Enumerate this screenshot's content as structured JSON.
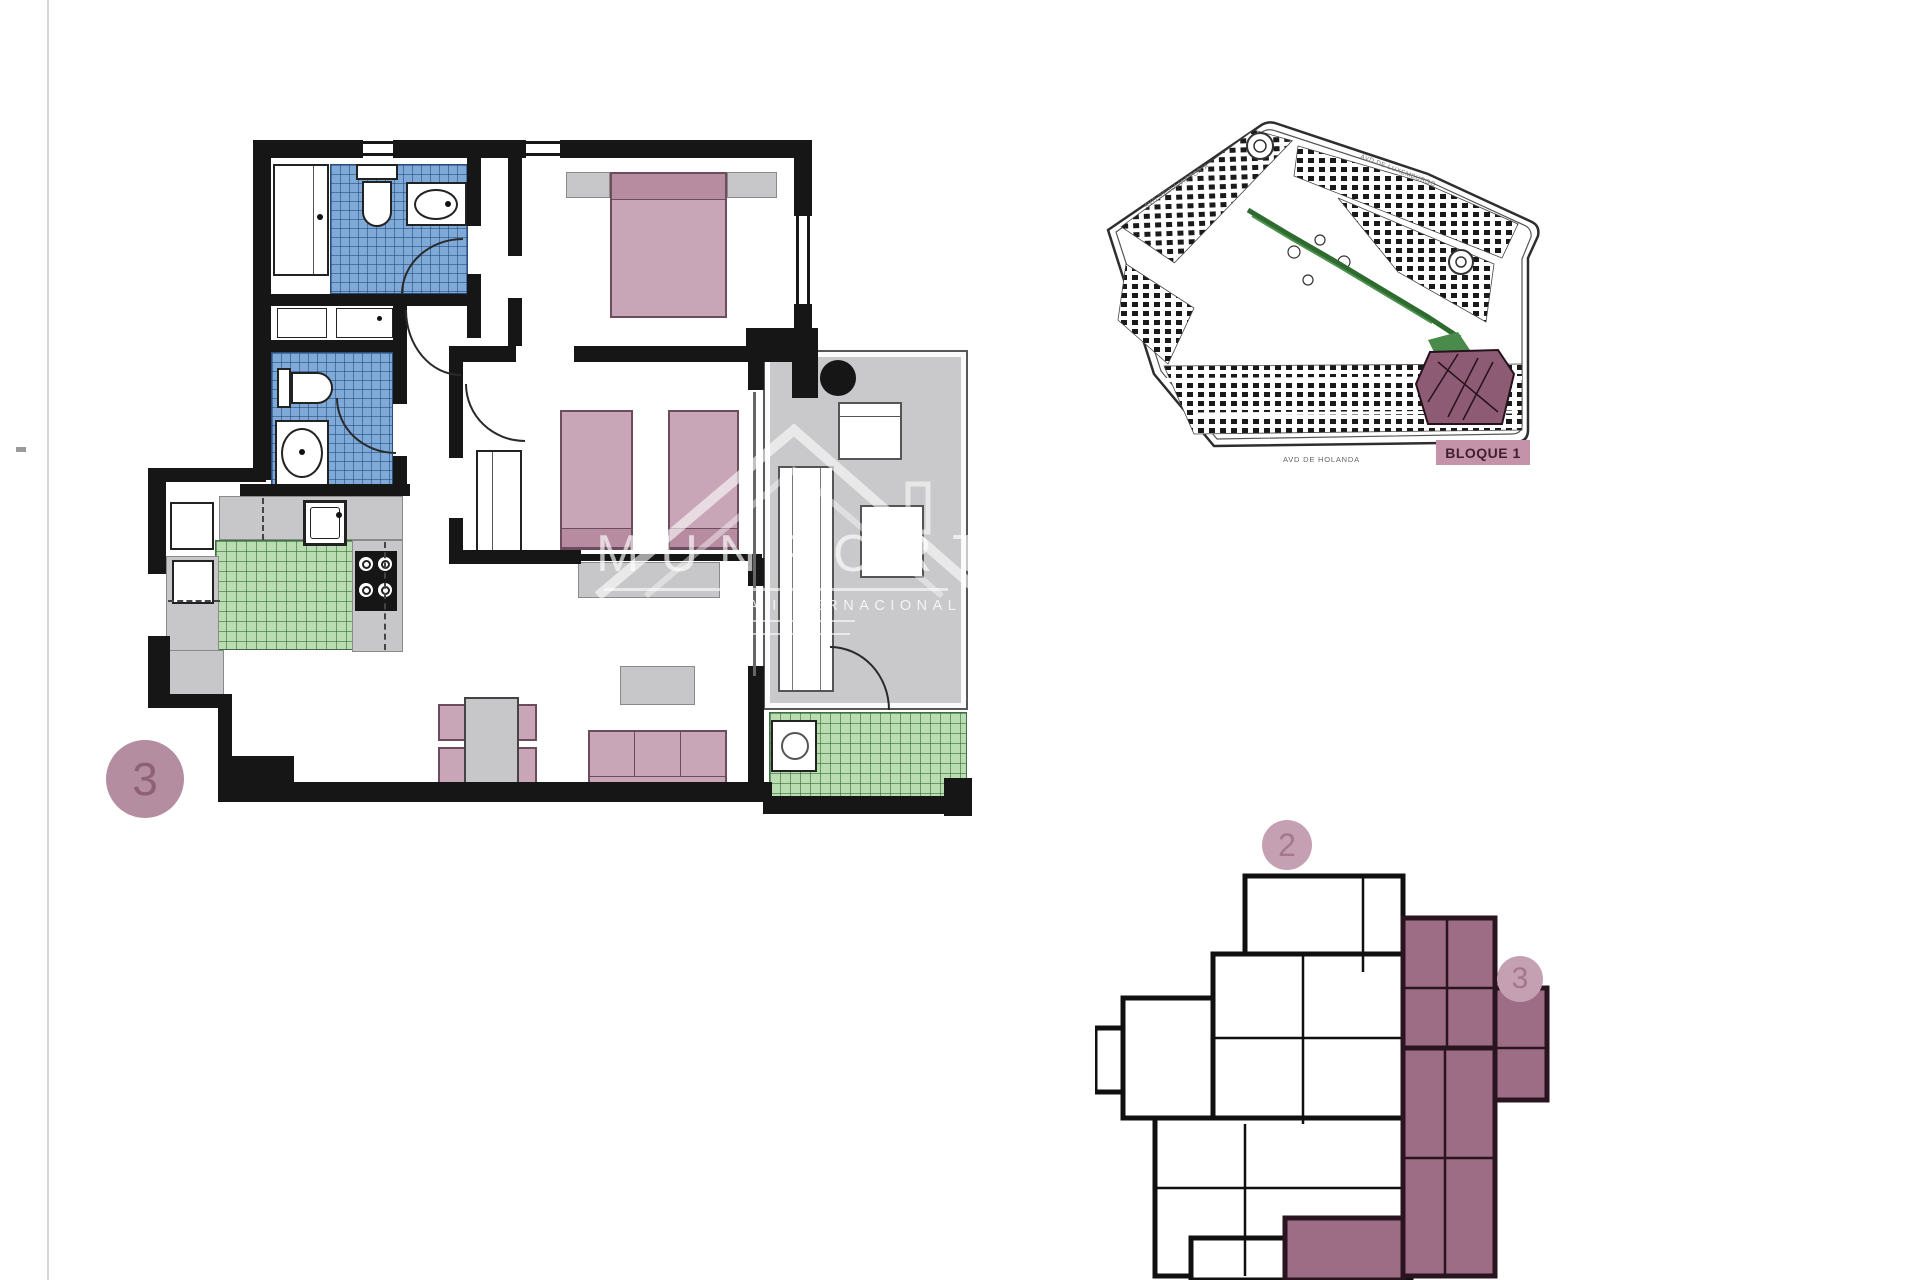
{
  "watermark": {
    "brand": "MUNPORT",
    "subtitle": "INMOBILIARIA INTERNACIONAL"
  },
  "main_plan": {
    "unit_marker": "3"
  },
  "site_plan": {
    "label_bloque": "BLOQUE 1",
    "street_top_left": "AVD REINA VICTORIA",
    "street_top_right": "AVD DE LUXEMBURGO",
    "street_bottom": "AVD DE HOLANDA"
  },
  "key_plan": {
    "unit_markers": [
      "2",
      "3"
    ]
  },
  "colors": {
    "wall": "#161616",
    "tile-blue": "#7fa9d6",
    "tile-green": "#b9dcb1",
    "furniture-pink": "#c8a5b7",
    "furniture-pink-dark": "#b78ca1",
    "terrace-gray": "#c9c9cb",
    "badge-mauve": "#b48da0",
    "badge-digit": "#8f6177",
    "highlight-maroon": "#9c6d84",
    "bloque-bg": "#c493aa",
    "path-green": "#2e6b2e"
  }
}
